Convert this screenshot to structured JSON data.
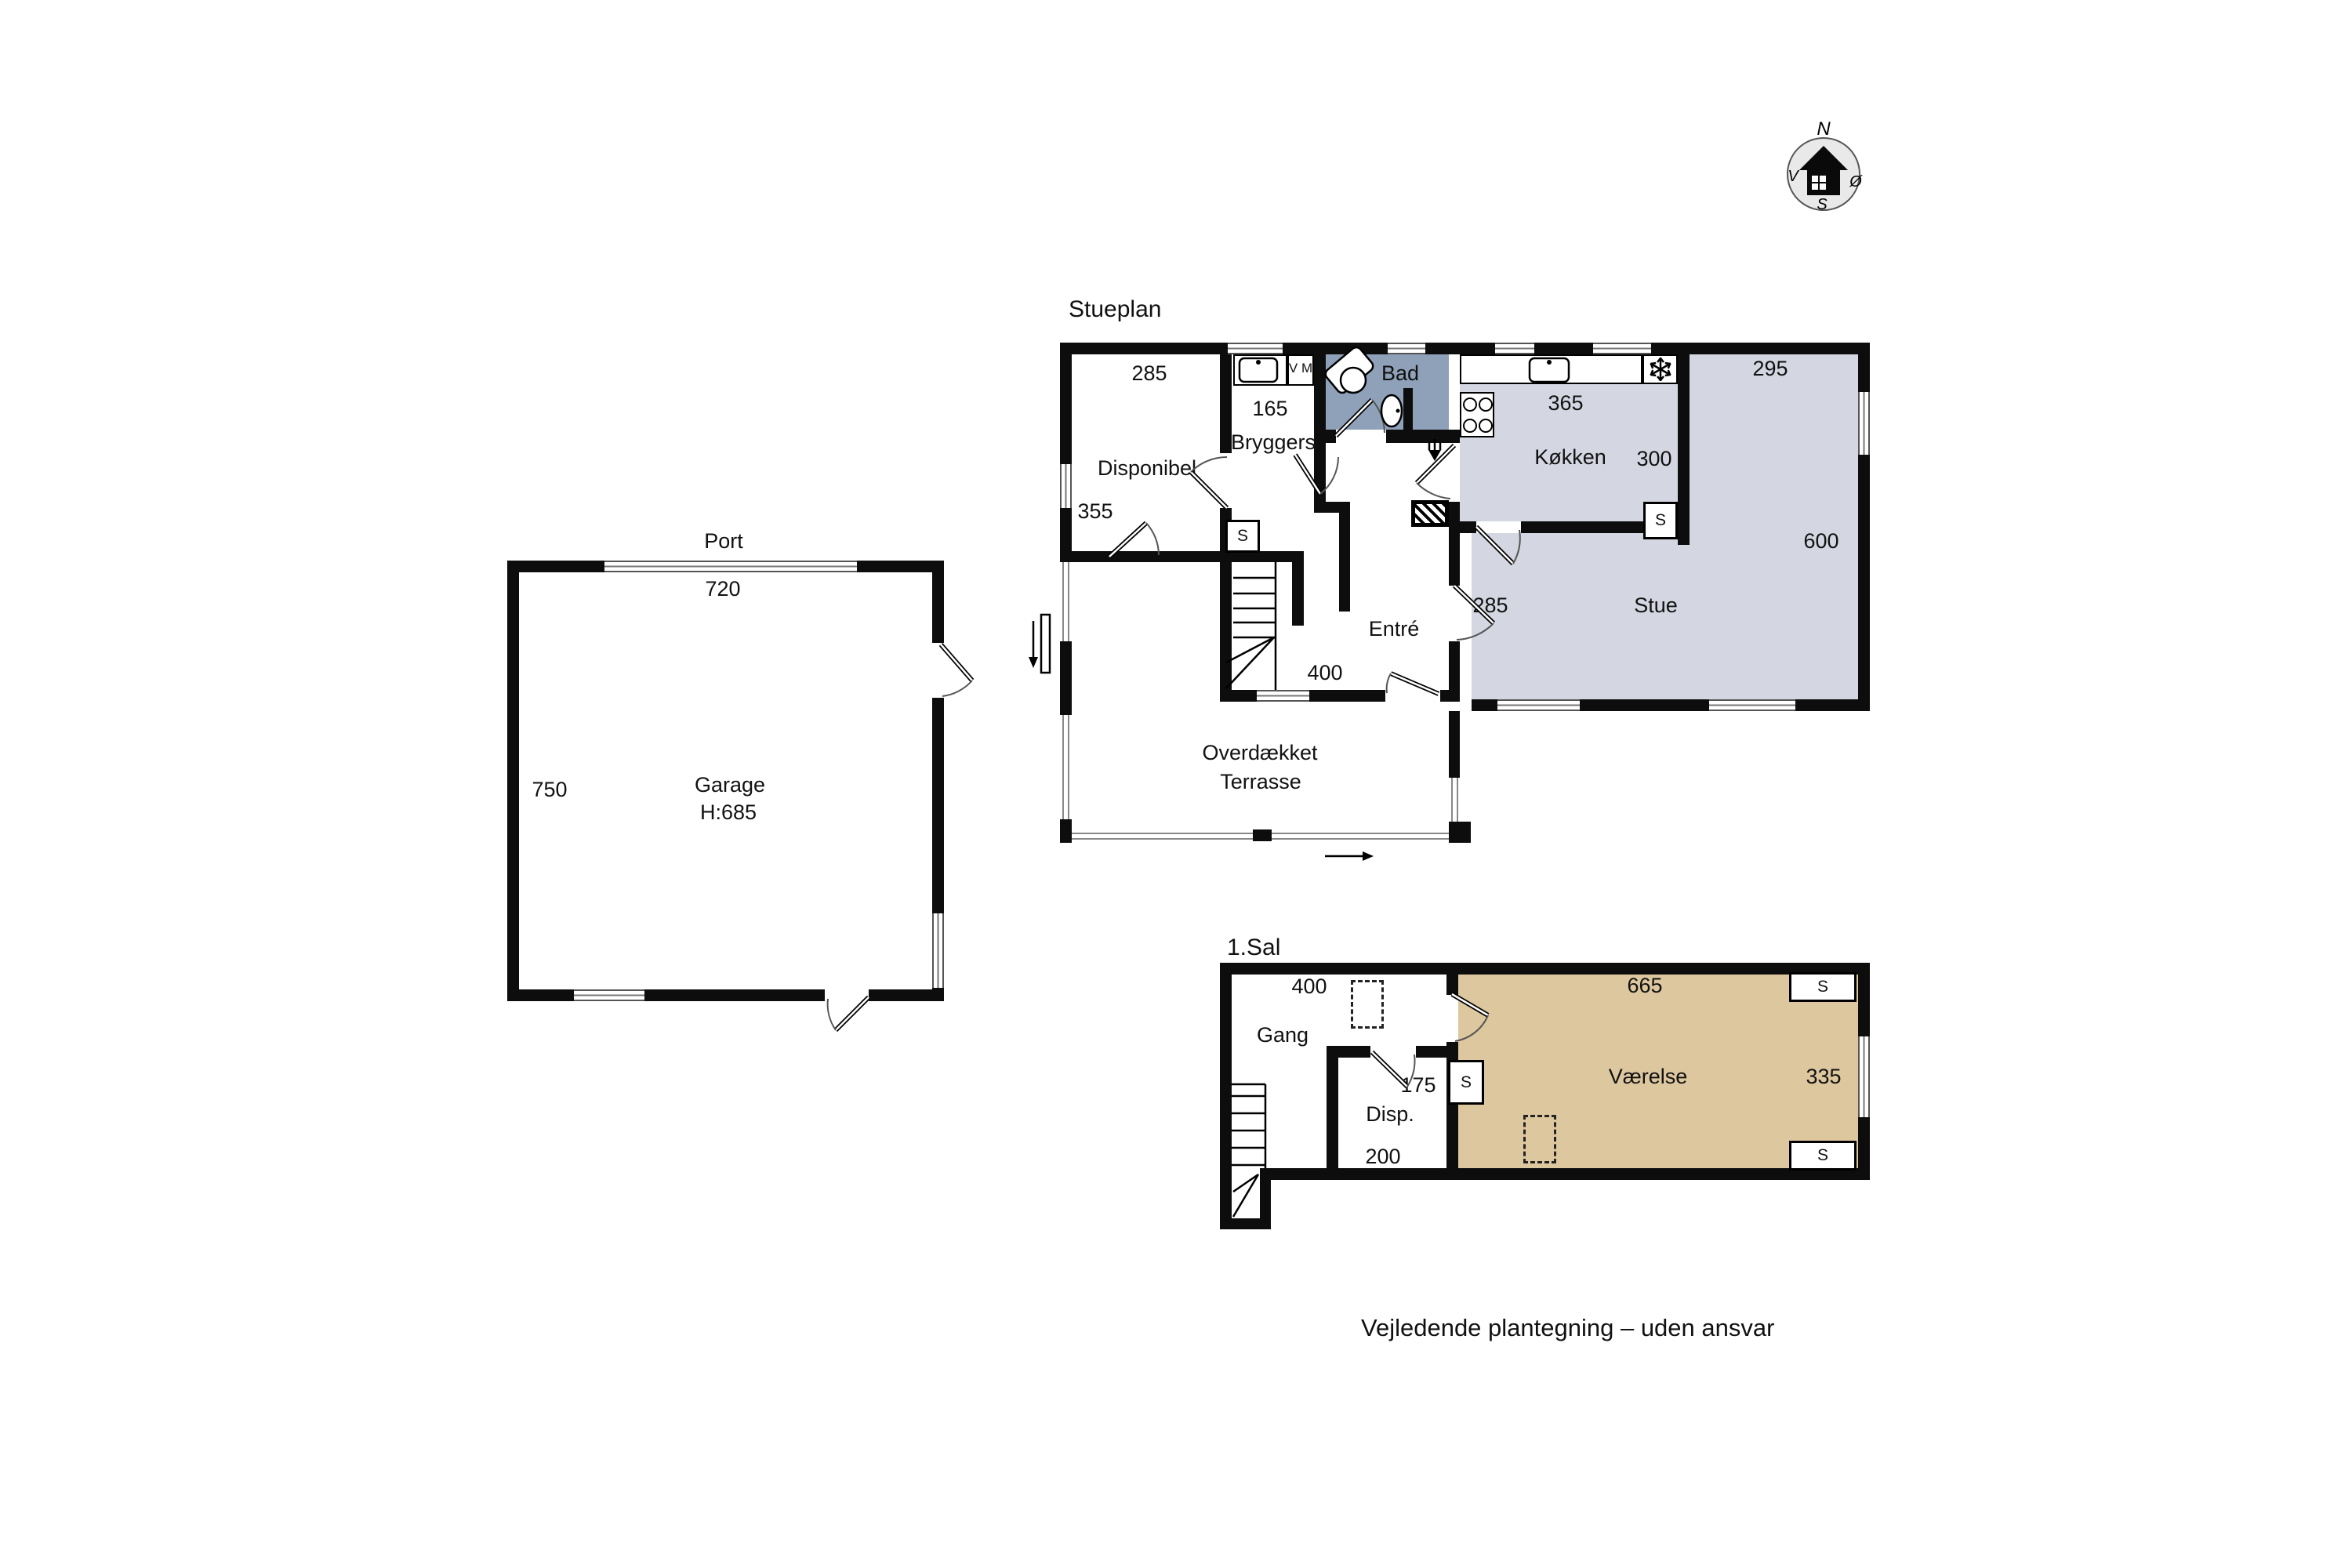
{
  "footer": "Vejledende plantegning – uden ansvar",
  "compass": {
    "north": "N",
    "west": "V",
    "east": "Ø",
    "south": "S"
  },
  "stueplan": {
    "title": "Stueplan",
    "disponibel": {
      "name": "Disponibel",
      "width": "285",
      "depth": "355"
    },
    "bryggers": {
      "name": "Bryggers",
      "width": "165",
      "washer": "V M"
    },
    "bad": {
      "name": "Bad"
    },
    "kokken": {
      "name": "Køkken",
      "width": "365",
      "depth": "300",
      "closet": "S"
    },
    "stue": {
      "name": "Stue",
      "width": "295",
      "depth": "600",
      "left_width": "285"
    },
    "entre": {
      "name": "Entré",
      "width": "400"
    },
    "hall_closet": "S",
    "terrasse": {
      "line1": "Overdækket",
      "line2": "Terrasse"
    }
  },
  "garage": {
    "name": "Garage",
    "door": "Port",
    "width": "720",
    "depth": "750",
    "ceiling": "H:685"
  },
  "first_floor": {
    "title": "1.Sal",
    "gang": {
      "name": "Gang",
      "width": "400"
    },
    "disp": {
      "name": "Disp.",
      "width": "200",
      "depth": "175"
    },
    "vaerelse": {
      "name": "Værelse",
      "width": "665",
      "depth": "335"
    },
    "closet": "S"
  },
  "colors": {
    "wall": "#0d0d0d",
    "living_fill": "#d4d7e1",
    "bath_fill": "#8ea1b9",
    "room_fill": "#ddc79f"
  }
}
